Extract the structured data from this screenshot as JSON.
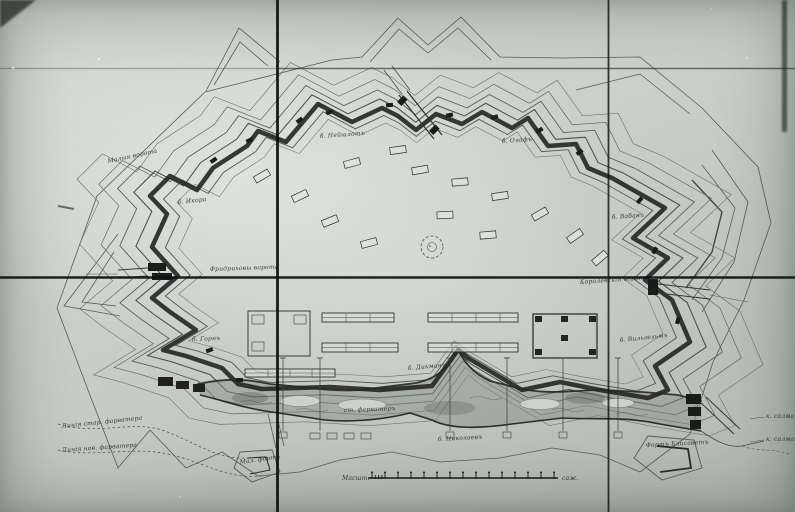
{
  "map": {
    "labels": {
      "small_gate_nw": "Малыя ворота",
      "bastion_nw": "б. Икора",
      "bastion_n_left": "б. Нейшлотъ",
      "bastion_n_right": "б. Олафъ",
      "bastion_ne": "б. Вабанъ",
      "gate_west": "Фридриховы ворота",
      "gate_east": "Королевскія ворота",
      "bastion_sw": "б. Горнъ",
      "ravelin_south": "б. Дикманъ",
      "bastion_se": "б. Вильгельмъ",
      "outwork_south": "б. Николаевъ",
      "channel": "ст. фарватеръ",
      "fairway_old": "Линія стар. фарватера",
      "fairway_new": "Линія нов. фарватера",
      "fort_small_south": "Мал. фортъ",
      "fort_southeast": "Фортъ Елисаветъ",
      "strait_upper": "к. салма",
      "strait_lower": "к. салма"
    },
    "scale_bar": {
      "label_left": "Масшт.",
      "label_right": "саж.",
      "tick_count": 15
    },
    "colors": {
      "paper_light": "#d6dbd4",
      "paper_dark": "#b1b8b2",
      "ink": "#2b2e2b",
      "water_wash": "#97a098",
      "fold_line": "#101010"
    }
  }
}
